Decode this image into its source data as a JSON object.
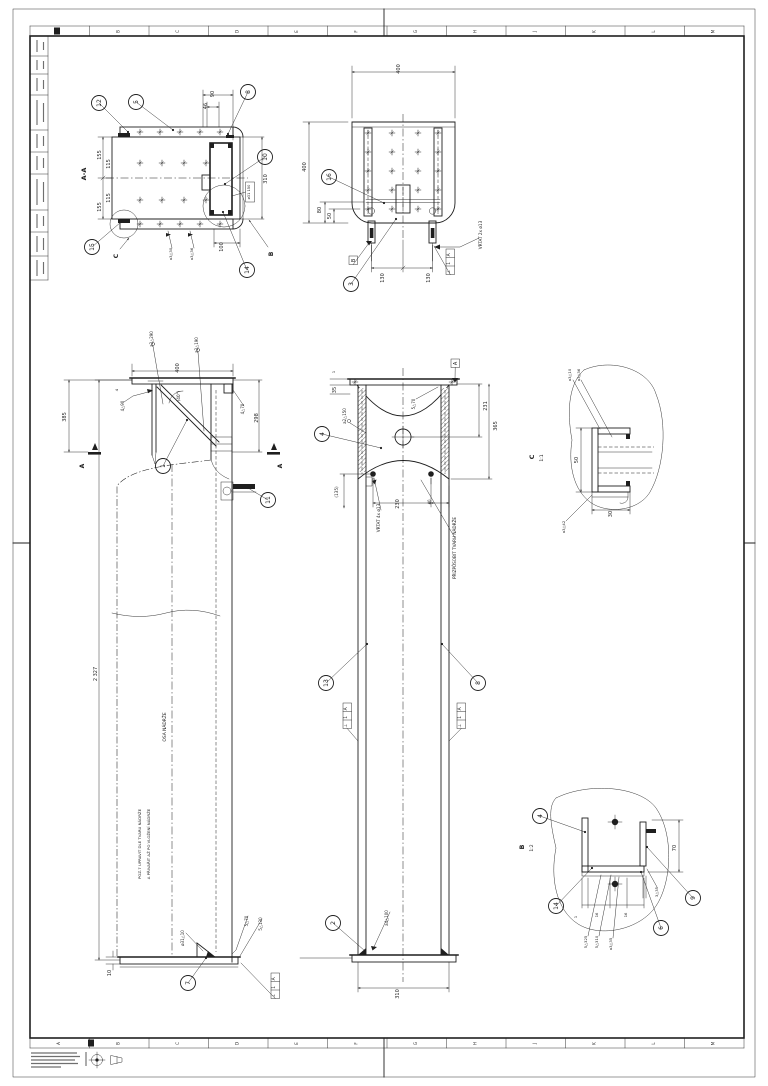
{
  "sheet": {
    "paper_color": "#ffffff",
    "line_color": "#1f1f1f",
    "type": "technical-drawing"
  },
  "border": {
    "zones": [
      "A",
      "B",
      "C",
      "D",
      "E",
      "F",
      "G",
      "H",
      "J",
      "K",
      "L",
      "M"
    ]
  },
  "annotations": [
    {
      "name": "aa-title",
      "t": "A-A",
      "x": 86,
      "y": 174,
      "s": 6.5,
      "b": 1
    },
    {
      "name": "aa-dim-155-top",
      "t": "155",
      "x": 101,
      "y": 155
    },
    {
      "name": "aa-dim-115-top",
      "t": "115",
      "x": 110,
      "y": 164
    },
    {
      "name": "aa-dim-115-bot",
      "t": "115",
      "x": 110,
      "y": 198
    },
    {
      "name": "aa-dim-155-bot",
      "t": "155",
      "x": 101,
      "y": 207
    },
    {
      "name": "aa-dim-90",
      "t": "90",
      "x": 214,
      "y": 94
    },
    {
      "name": "aa-dim-46",
      "t": "46",
      "x": 207,
      "y": 106
    },
    {
      "name": "aa-dim-310",
      "t": "310",
      "x": 267,
      "y": 179
    },
    {
      "name": "aa-dim-o31",
      "t": "ø31 150",
      "x": 250,
      "y": 192,
      "s": 3.6
    },
    {
      "name": "aa-dim-100",
      "t": "100",
      "x": 223,
      "y": 247
    },
    {
      "name": "aa-weld-a3-30",
      "t": "a3△30",
      "x": 172,
      "y": 254,
      "s": 3.8
    },
    {
      "name": "aa-weld-a3-36",
      "t": "a3△36",
      "x": 193,
      "y": 254,
      "s": 3.8
    },
    {
      "name": "aa-view-arrow-c",
      "t": "C",
      "x": 118,
      "y": 256,
      "s": 6,
      "b": 1
    },
    {
      "name": "aa-view-arrow-b",
      "t": "B",
      "x": 273,
      "y": 254,
      "s": 6,
      "b": 1
    },
    {
      "name": "v2-dim-400-top",
      "t": "400",
      "x": 400,
      "y": 69
    },
    {
      "name": "v2-dim-400-left",
      "t": "400",
      "x": 306,
      "y": 167
    },
    {
      "name": "v2-dim-80",
      "t": "80",
      "x": 321,
      "y": 210
    },
    {
      "name": "v2-dim-50",
      "t": "50",
      "x": 331,
      "y": 216
    },
    {
      "name": "v2-dim-130-l",
      "t": "130",
      "x": 384,
      "y": 278
    },
    {
      "name": "v2-dim-130-r",
      "t": "130",
      "x": 430,
      "y": 278
    },
    {
      "name": "v2-note-vrtat",
      "t": "VRTAT 2x ø13",
      "x": 482,
      "y": 235,
      "s": 4.2
    },
    {
      "name": "v3-dim-385",
      "t": "385",
      "x": 66,
      "y": 417
    },
    {
      "name": "v3-dim-400",
      "t": "400",
      "x": 179,
      "y": 368
    },
    {
      "name": "v3-dim-298",
      "t": "298",
      "x": 258,
      "y": 418
    },
    {
      "name": "v3-dim-4",
      "t": "4",
      "x": 118,
      "y": 390,
      "s": 3.8
    },
    {
      "name": "v3-weld-4-90",
      "t": "4△90",
      "x": 124,
      "y": 406,
      "s": 4
    },
    {
      "name": "v3-weld-4-70",
      "t": "4△70",
      "x": 244,
      "y": 409,
      "s": 4
    },
    {
      "name": "v3-weld-a2-290",
      "t": "a2△290",
      "x": 153,
      "y": 339,
      "s": 4
    },
    {
      "name": "v3-weld-a2-190",
      "t": "a2△190",
      "x": 198,
      "y": 345,
      "s": 4
    },
    {
      "name": "v3-dim-40deg",
      "t": "(40°)",
      "x": 180,
      "y": 396,
      "s": 4.2
    },
    {
      "name": "v3-dim-2327",
      "t": "2 327",
      "x": 97,
      "y": 674
    },
    {
      "name": "v3-axis-label",
      "t": "OSA NÁDRŽE",
      "x": 166,
      "y": 727,
      "s": 4.4
    },
    {
      "name": "v3-note-line1",
      "t": "POZ.7 UPRAVIT DLE TVARU NÁDRŽE",
      "x": 141,
      "y": 844,
      "s": 3.9
    },
    {
      "name": "v3-note-line2",
      "t": "A PŘIVAŘIT AŽ PO VLOŽENÍ NÁDRŽE",
      "x": 150,
      "y": 844,
      "s": 3.9
    },
    {
      "name": "v3-dim-10",
      "t": "10",
      "x": 111,
      "y": 973
    },
    {
      "name": "v3-weld-o31-10",
      "t": "ø31△10",
      "x": 184,
      "y": 938,
      "s": 4
    },
    {
      "name": "v3-weld-5-70",
      "t": "5△70",
      "x": 248,
      "y": 921,
      "s": 4
    },
    {
      "name": "v3-weld-5-130",
      "t": "5△130",
      "x": 262,
      "y": 924,
      "s": 4
    },
    {
      "name": "v3-section-a-left",
      "t": "A",
      "x": 84,
      "y": 466,
      "s": 6,
      "b": 1
    },
    {
      "name": "v3-section-a-right",
      "t": "A",
      "x": 282,
      "y": 466,
      "s": 6,
      "b": 1
    },
    {
      "name": "v4-dim-1",
      "t": "1",
      "x": 335,
      "y": 372,
      "s": 3.8
    },
    {
      "name": "v4-dim-35",
      "t": "35",
      "x": 336,
      "y": 390
    },
    {
      "name": "v4-dim-231",
      "t": "231",
      "x": 487,
      "y": 406
    },
    {
      "name": "v4-dim-365",
      "t": "365",
      "x": 497,
      "y": 426
    },
    {
      "name": "v4-weld-a2-150",
      "t": "a2△150",
      "x": 346,
      "y": 416,
      "s": 4
    },
    {
      "name": "v4-weld-5-70",
      "t": "5△70",
      "x": 415,
      "y": 404,
      "s": 4
    },
    {
      "name": "v4-dim-135",
      "t": "(135)",
      "x": 338,
      "y": 492,
      "s": 4.2
    },
    {
      "name": "v4-dim-230",
      "t": "230",
      "x": 399,
      "y": 504
    },
    {
      "name": "v4-dim-40",
      "t": "40",
      "x": 431,
      "y": 502,
      "s": 4
    },
    {
      "name": "v4-note-vrtat4",
      "t": "VRTAT 4x ø13",
      "x": 380,
      "y": 518,
      "s": 4.2
    },
    {
      "name": "v4-note-prizpusobit",
      "t": "PŘIZPŮSOBIT TVARU NÁDRŽE",
      "x": 456,
      "y": 548,
      "s": 4.2
    },
    {
      "name": "v4-weld-a4-100",
      "t": "a4△100",
      "x": 388,
      "y": 918,
      "s": 4
    },
    {
      "name": "v4-dim-310",
      "t": "310",
      "x": 399,
      "y": 994
    },
    {
      "name": "c-detail-title",
      "t": "C",
      "x": 534,
      "y": 457,
      "s": 6.5,
      "b": 1
    },
    {
      "name": "c-detail-scale",
      "t": "1:1",
      "x": 543,
      "y": 458,
      "s": 4.5
    },
    {
      "name": "c-weld-a3-10",
      "t": "a3△10",
      "x": 571,
      "y": 375,
      "s": 3.8
    },
    {
      "name": "c-weld-a3-36",
      "t": "a3△36",
      "x": 580,
      "y": 375,
      "s": 3.8
    },
    {
      "name": "c-weld-a3-42",
      "t": "a3△42",
      "x": 565,
      "y": 527,
      "s": 3.8
    },
    {
      "name": "c-dim-50",
      "t": "50",
      "x": 578,
      "y": 460
    },
    {
      "name": "c-dim-30",
      "t": "30",
      "x": 612,
      "y": 514
    },
    {
      "name": "b-detail-title",
      "t": "B",
      "x": 524,
      "y": 847,
      "s": 6.5,
      "b": 1
    },
    {
      "name": "b-detail-scale",
      "t": "1:2",
      "x": 533,
      "y": 848,
      "s": 4.5
    },
    {
      "name": "b-dim-70",
      "t": "70",
      "x": 676,
      "y": 848
    },
    {
      "name": "b-weld-3-35",
      "t": "3△35",
      "x": 658,
      "y": 892,
      "s": 3.8
    },
    {
      "name": "b-weld-5-325",
      "t": "5△325",
      "x": 587,
      "y": 942,
      "s": 3.8
    },
    {
      "name": "b-weld-5-310",
      "t": "5△310",
      "x": 598,
      "y": 942,
      "s": 3.8
    },
    {
      "name": "b-weld-a3-35",
      "t": "a3△35",
      "x": 612,
      "y": 944,
      "s": 3.8
    },
    {
      "name": "b-dim-1",
      "t": "1",
      "x": 577,
      "y": 917,
      "s": 3.8
    },
    {
      "name": "b-dim-16a",
      "t": "16",
      "x": 598,
      "y": 915,
      "s": 3.8
    },
    {
      "name": "b-dim-16b",
      "t": "16",
      "x": 627,
      "y": 915,
      "s": 3.8
    }
  ],
  "balloons": [
    {
      "n": "12",
      "x": 99,
      "y": 103,
      "lx": 128,
      "ly": 132
    },
    {
      "n": "5",
      "x": 136,
      "y": 102,
      "lx": 173,
      "ly": 130
    },
    {
      "n": "8",
      "x": 248,
      "y": 92,
      "lx": 228,
      "ly": 134
    },
    {
      "n": "10",
      "x": 265,
      "y": 157,
      "lx": 225,
      "ly": 184
    },
    {
      "n": "15",
      "x": 92,
      "y": 247,
      "lx": 121,
      "ly": 222
    },
    {
      "n": "14",
      "x": 247,
      "y": 270,
      "lx": 223,
      "ly": 212
    },
    {
      "n": "16",
      "x": 329,
      "y": 177,
      "lx": 384,
      "ly": 203
    },
    {
      "n": "3",
      "x": 351,
      "y": 284,
      "lx": 396,
      "ly": 219
    },
    {
      "n": "1",
      "x": 163,
      "y": 466,
      "lx": 187,
      "ly": 420
    },
    {
      "n": "11",
      "x": 268,
      "y": 500,
      "lx": 248,
      "ly": 488
    },
    {
      "n": "7",
      "x": 188,
      "y": 983,
      "lx": 206,
      "ly": 958
    },
    {
      "n": "4",
      "x": 322,
      "y": 434,
      "lx": 381,
      "ly": 448
    },
    {
      "n": "13",
      "x": 326,
      "y": 683,
      "lx": 367,
      "ly": 644
    },
    {
      "n": "8",
      "x": 478,
      "y": 683,
      "lx": 442,
      "ly": 644
    },
    {
      "n": "2",
      "x": 333,
      "y": 923,
      "lx": 365,
      "ly": 951
    },
    {
      "n": "4",
      "x": 540,
      "y": 816,
      "lx": 585,
      "ly": 832
    },
    {
      "n": "14",
      "x": 556,
      "y": 906,
      "lx": 592,
      "ly": 868
    },
    {
      "n": "9",
      "x": 693,
      "y": 898,
      "lx": 647,
      "ly": 847
    },
    {
      "n": "6",
      "x": 661,
      "y": 928,
      "lx": 641,
      "ly": 872
    }
  ],
  "feature_control_frames": [
    {
      "cells": [
        "A",
        "1",
        "⊥"
      ],
      "x": 446,
      "y": 249,
      "lx": 434,
      "ly": 246
    },
    {
      "cells": [
        "A",
        "1",
        "⊥"
      ],
      "x": 271,
      "y": 973,
      "lx": 241,
      "ly": 963
    },
    {
      "cells": [
        "A",
        "1",
        "⊥"
      ],
      "x": 343,
      "y": 703,
      "lx": 358,
      "ly": 741
    },
    {
      "cells": [
        "A",
        "1",
        "⊥"
      ],
      "x": 457,
      "y": 703,
      "lx": 449,
      "ly": 741
    }
  ],
  "datums": [
    {
      "t": "B",
      "x": 349,
      "y": 256,
      "lx": 369,
      "ly": 243
    },
    {
      "t": "A",
      "x": 451,
      "y": 359,
      "lx": 455,
      "ly": 380
    }
  ]
}
